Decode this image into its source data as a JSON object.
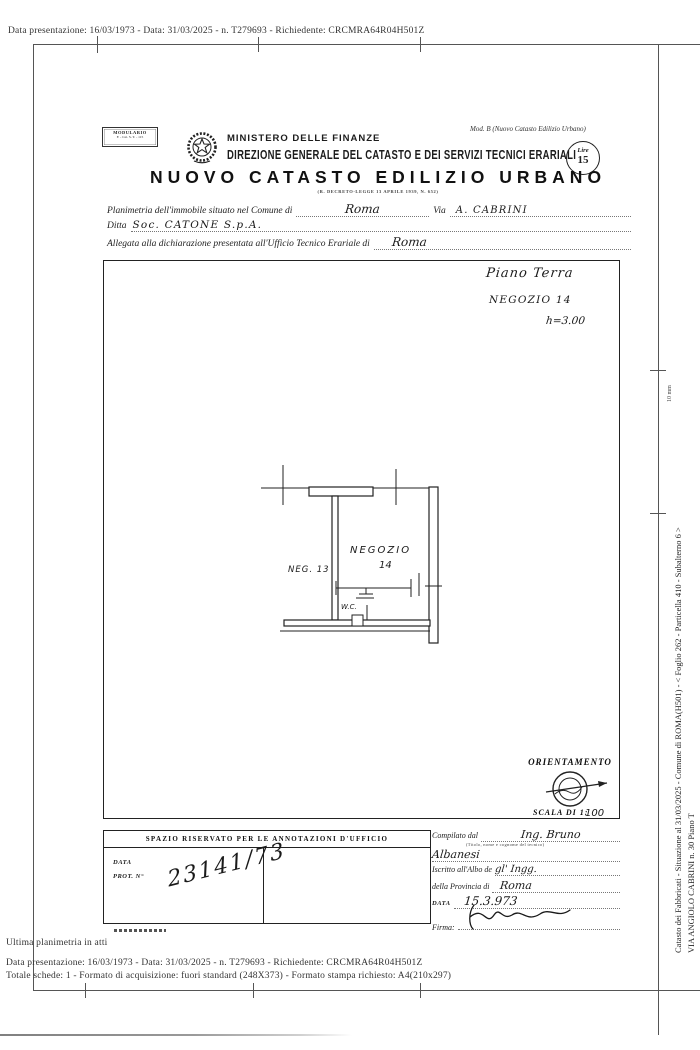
{
  "page": {
    "top_line": "Data presentazione: 16/03/1973 - Data: 31/03/2025 - n. T279693 - Richiedente: CRCMRA64R04H501Z",
    "ultima_note": "Ultima planimetria in atti",
    "footer_line1": "Data presentazione: 16/03/1973 - Data: 31/03/2025 - n. T279693 - Richiedente: CRCMRA64R04H501Z",
    "footer_line2": "Totale schede: 1 - Formato di acquisizione: fuori standard (248X373) - Formato stampa richiesto: A4(210x297)"
  },
  "margin": {
    "side_line1": "Catasto dei Fabbricati - Situazione al 31/03/2025 - Comune di ROMA(H501) - <  Foglio 262 - Particella 410 - Subalterno 6 >",
    "side_line2": "VIA ANGIOLO CABRINI n. 30 Piano T",
    "ruler_label": "10 mm"
  },
  "header": {
    "modulario_line1": "MODULARIO",
    "modulario_line2": "F. - Cat. S. T. - 115",
    "ministry": "MINISTERO DELLE FINANZE",
    "direction": "DIREZIONE GENERALE DEL CATASTO E DEI SERVIZI TECNICI ERARIALI",
    "mod_b": "Mod. B (Nuovo Catasto Edilizio Urbano)",
    "stamp_top": "Lire",
    "stamp_value": "15",
    "title": "NUOVO CATASTO EDILIZIO URBANO",
    "subtitle": "(R. DECRETO-LEGGE 13 APRILE 1939, N. 652)"
  },
  "form": {
    "comune_label": "Planimetria dell'immobile situato nel Comune di",
    "comune_value": "Roma",
    "via_label": "Via",
    "via_value": "A. CABRINI",
    "ditta_label": "Ditta",
    "ditta_value": "Soc. CATONE S.p.A.",
    "allegata_label": "Allegata alla dichiarazione presentata all'Ufficio Tecnico Erariale di",
    "allegata_value": "Roma"
  },
  "plan": {
    "note_floor": "Piano Terra",
    "note_unit": "NEGOZIO 14",
    "note_height": "h=3.00",
    "label_negozio": "NEGOZIO",
    "label_negozio_num": "14",
    "label_neg13": "NEG. 13",
    "label_wc": "W.C.",
    "orientamento": "ORIENTAMENTO",
    "scala_label": "SCALA DI 1:",
    "scala_value": "100"
  },
  "annotations": {
    "box_title": "SPAZIO RISERVATO PER LE ANNOTAZIONI D'UFFICIO",
    "data_label": "DATA",
    "prot_label": "PROT. N°",
    "prot_value": "23141/73"
  },
  "tech": {
    "compilato_label": "Compilato dal",
    "compilato_value": "Ing. Bruno",
    "compilato_hint": "(Titolo, nome e cognome del tecnico)",
    "surname_value": "Albanesi",
    "albo_label": "Iscritto all'Albo de",
    "albo_value": "gl' Ingg.",
    "provincia_label": "della Provincia di",
    "provincia_value": "Roma",
    "date_label": "DATA",
    "date_value": "15.3.973",
    "firma_label": "Firma:"
  }
}
